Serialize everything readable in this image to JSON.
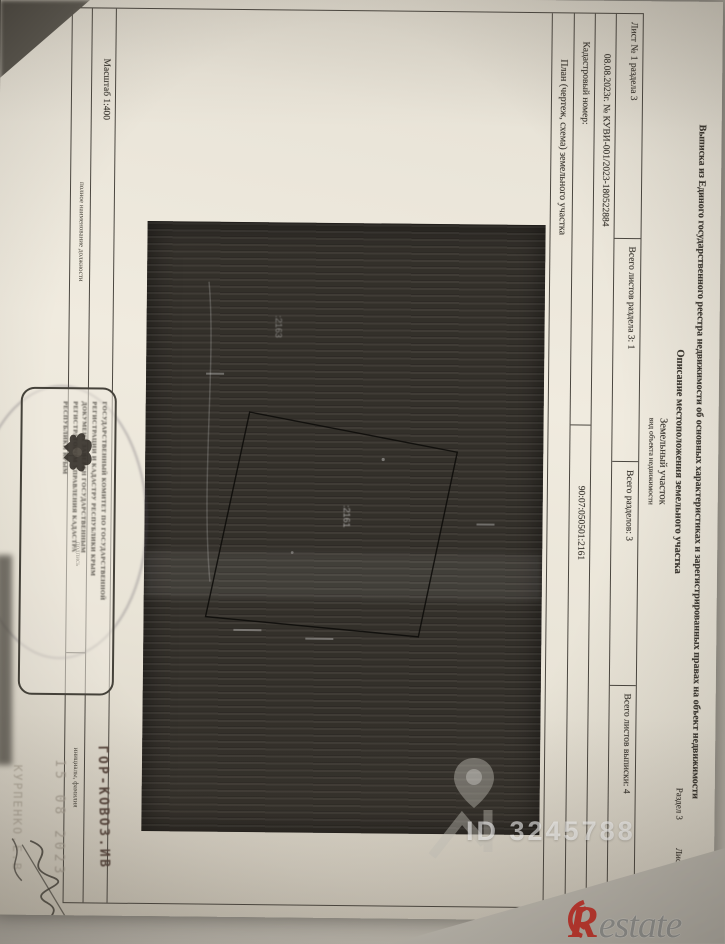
{
  "photo": {
    "id_watermark": "ID 3245788",
    "brand_r": "R",
    "brand_rest": "estate"
  },
  "page": {
    "corner_razdel": "Раздел 3",
    "corner_list": "Лист 4",
    "title": "Выписка из Единого государственного реестра недвижимости об основных характеристиках и зарегистрированных правах на объект недвижимости",
    "section_title": "Описание местоположения земельного участка",
    "object_type": "Земельный участок",
    "object_type_caption": "вид объекта недвижимости",
    "sheet_row": [
      "Лист № 1 раздела 3",
      "Всего листов раздела 3: 1",
      "Всего разделов: 3",
      "Всего листов выписки: 4"
    ],
    "date_number": "08.08.2023г. № КУВИ-001/2023-180522884",
    "cadastral_label": "Кадастровый номер:",
    "cadastral_value": "90:07:050501:2161",
    "plan_label": "План (чертеж, схема) земельного участка",
    "parcel_label": ":2161",
    "neighbor_label": ":2163",
    "scale_label": "Масштаб 1:400",
    "footer_labels": [
      "полное наименование должности",
      "подпись",
      "инициалы, фамилия"
    ],
    "stamp_lines": [
      "ГОСУДАРСТВЕННЫЙ КОМИТЕТ ПО ГОСУДАРСТВЕННОЙ",
      "РЕГИСТРАЦИИ И КАДАСТРУ РЕСПУБЛИКИ КРЫМ",
      "ДОКУМЕНТ ЗАВЕРЕН ГОСУДАРСТВЕННЫМ",
      "РЕГИСТРАТОРОМ УПРАВЛЕНИЯ КАДАСТРА",
      "РЕСПУБЛИКИ КРЫМ"
    ],
    "facsimile_name": "ГОР-КОВОЗ.ИВ",
    "facsimile_date": "15 08 2023",
    "facsimile_name2": "КУРПЕНКО.Е.В"
  }
}
